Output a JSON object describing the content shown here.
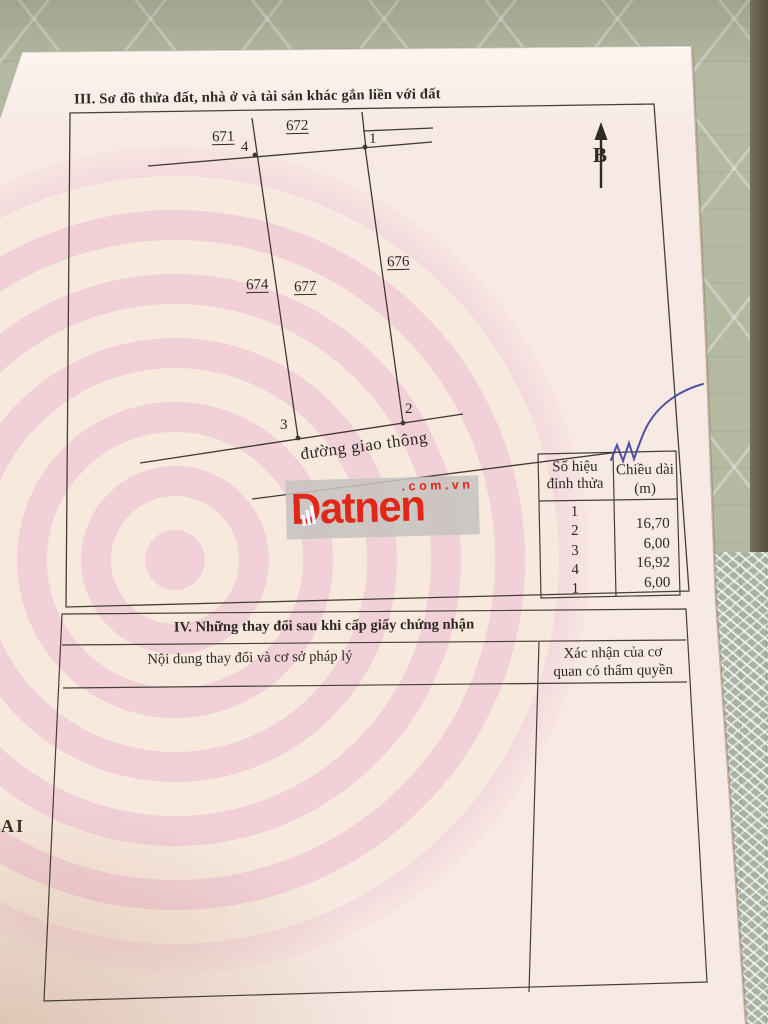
{
  "photo": {
    "edge_fragment": "AI"
  },
  "watermark": {
    "brand": "Datnen",
    "domain_suffix": ".com.vn"
  },
  "section_iii": {
    "title": "III. Sơ đồ thửa đất, nhà ở và tài sản khác gắn liền với đất",
    "north_label": "B",
    "road_label": "đường giao thông",
    "parcels": [
      "671",
      "672",
      "674",
      "676",
      "677"
    ],
    "vertices": {
      "v1": "1",
      "v2": "2",
      "v3": "3",
      "v4": "4"
    },
    "dimension_table": {
      "header_col1_line1": "Số hiệu",
      "header_col1_line2": "đỉnh thửa",
      "header_col2_line1": "Chiều dài",
      "header_col2_line2": "(m)",
      "vertex_ids": [
        "1",
        "2",
        "3",
        "4",
        "1"
      ],
      "lengths": [
        "16,70",
        "6,00",
        "16,92",
        "6,00"
      ]
    }
  },
  "section_iv": {
    "title": "IV. Những thay đổi sau khi cấp giấy chứng nhận",
    "col1_header": "Nội dung thay đổi và cơ sở pháp lý",
    "col2_header_line1": "Xác nhận của cơ",
    "col2_header_line2": "quan có thẩm quyền"
  },
  "colors": {
    "brand_red": "#e12718",
    "pen_ink_blue": "#41439b",
    "page_pink": "#f7e8e4",
    "line_dark": "#463f37"
  }
}
